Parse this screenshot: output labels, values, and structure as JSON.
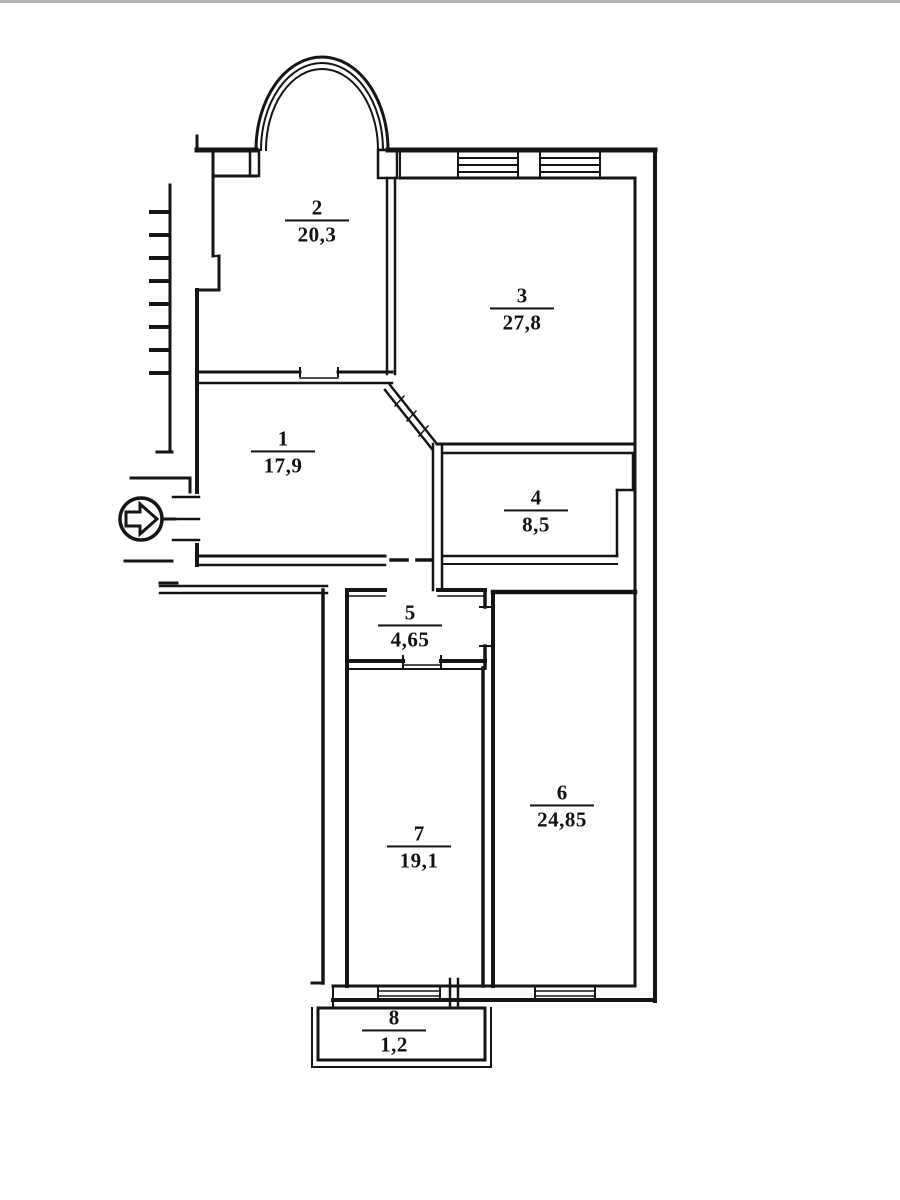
{
  "page": {
    "background": "#ffffff",
    "line_color": "#151515",
    "kind": "scanned apartment floor plan"
  },
  "plan": {
    "rooms": [
      {
        "id": "room-1",
        "number": "1",
        "area": "17,9"
      },
      {
        "id": "room-2",
        "number": "2",
        "area": "20,3"
      },
      {
        "id": "room-3",
        "number": "3",
        "area": "27,8"
      },
      {
        "id": "room-4",
        "number": "4",
        "area": "8,5"
      },
      {
        "id": "room-5",
        "number": "5",
        "area": "4,65"
      },
      {
        "id": "room-6",
        "number": "6",
        "area": "24,85"
      },
      {
        "id": "room-7",
        "number": "7",
        "area": "19,1"
      },
      {
        "id": "room-8",
        "number": "8",
        "area": "1,2"
      }
    ],
    "entrance": {
      "icon": "entrance-arrow-icon",
      "direction": "right"
    },
    "features": {
      "arched_bay": "top of room 2",
      "balcony": "room 8 at bottom",
      "windows": "hatched wall sections top and bottom"
    }
  }
}
